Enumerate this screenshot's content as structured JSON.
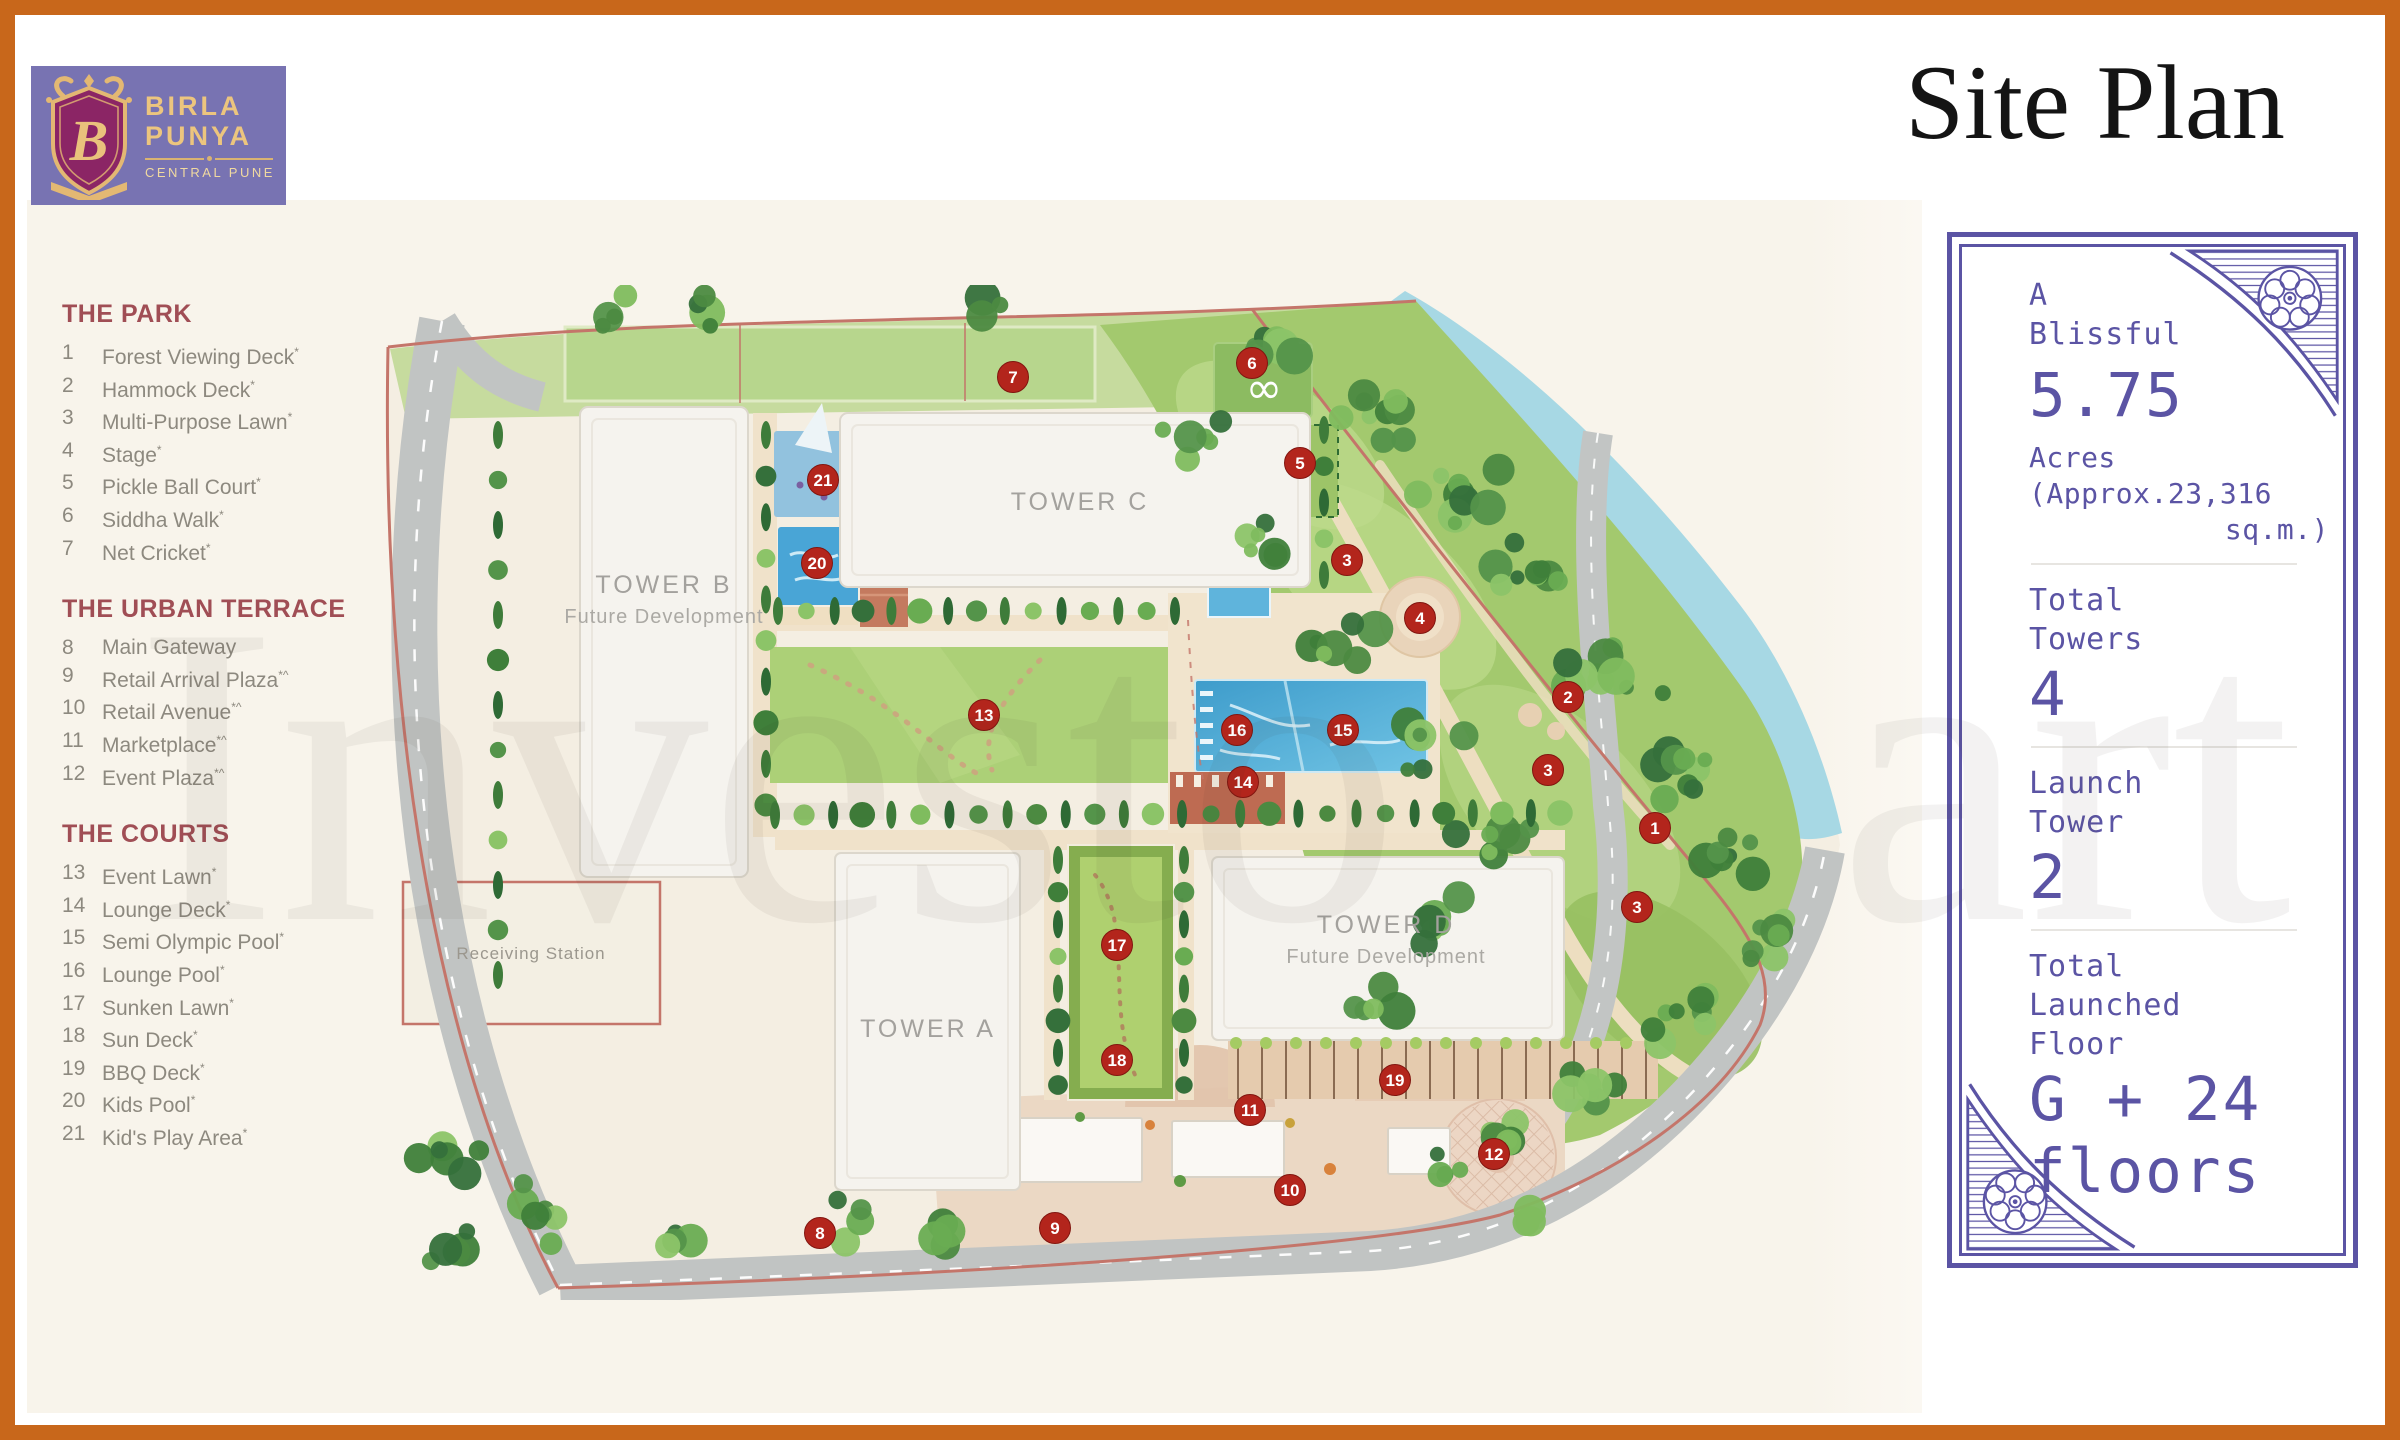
{
  "logo": {
    "name_line1": "BIRLA",
    "name_line2": "PUNYA",
    "tagline": "CENTRAL PUNE",
    "monogram": "B"
  },
  "header": {
    "title": "Site Plan"
  },
  "watermark": {
    "left_text": "Investo",
    "right_text": "art"
  },
  "legend": {
    "sections": [
      {
        "title": "THE PARK",
        "items": [
          {
            "n": "1",
            "label": "Forest Viewing Deck",
            "sup": "*"
          },
          {
            "n": "2",
            "label": "Hammock Deck",
            "sup": "*"
          },
          {
            "n": "3",
            "label": "Multi-Purpose Lawn",
            "sup": "*"
          },
          {
            "n": "4",
            "label": "Stage",
            "sup": "*"
          },
          {
            "n": "5",
            "label": "Pickle Ball Court",
            "sup": "*"
          },
          {
            "n": "6",
            "label": "Siddha Walk",
            "sup": "*"
          },
          {
            "n": "7",
            "label": "Net Cricket",
            "sup": "*"
          }
        ]
      },
      {
        "title": "THE URBAN TERRACE",
        "items": [
          {
            "n": "8",
            "label": "Main Gateway",
            "sup": ""
          },
          {
            "n": "9",
            "label": "Retail Arrival Plaza",
            "sup": "*^"
          },
          {
            "n": "10",
            "label": "Retail Avenue",
            "sup": "*^"
          },
          {
            "n": "11",
            "label": "Marketplace",
            "sup": "*^"
          },
          {
            "n": "12",
            "label": "Event Plaza",
            "sup": "*^"
          }
        ]
      },
      {
        "title": "THE COURTS",
        "items": [
          {
            "n": "13",
            "label": "Event Lawn",
            "sup": "*"
          },
          {
            "n": "14",
            "label": "Lounge Deck",
            "sup": "*"
          },
          {
            "n": "15",
            "label": "Semi Olympic Pool",
            "sup": "*"
          },
          {
            "n": "16",
            "label": "Lounge Pool",
            "sup": "*"
          },
          {
            "n": "17",
            "label": "Sunken Lawn",
            "sup": "*"
          },
          {
            "n": "18",
            "label": "Sun Deck",
            "sup": "*"
          },
          {
            "n": "19",
            "label": "BBQ Deck",
            "sup": "*"
          },
          {
            "n": "20",
            "label": "Kids Pool",
            "sup": "*"
          },
          {
            "n": "21",
            "label": "Kid's Play Area",
            "sup": "*"
          }
        ]
      }
    ]
  },
  "map": {
    "towers": [
      {
        "id": "tower-b",
        "label": "TOWER B",
        "sublabel": "Future Development",
        "x": 284,
        "y": 308
      },
      {
        "id": "tower-c",
        "label": "TOWER C",
        "sublabel": "",
        "x": 700,
        "y": 225
      },
      {
        "id": "tower-a",
        "label": "TOWER A",
        "sublabel": "",
        "x": 548,
        "y": 752
      },
      {
        "id": "tower-d",
        "label": "TOWER D",
        "sublabel": "Future Development",
        "x": 1006,
        "y": 648
      }
    ],
    "areas": [
      {
        "id": "receiving-station",
        "label": "Receiving Station",
        "x": 151,
        "y": 674
      }
    ],
    "infinity_symbol": "∞",
    "markers": [
      {
        "n": "1",
        "x": 1275,
        "y": 543
      },
      {
        "n": "2",
        "x": 1188,
        "y": 412
      },
      {
        "n": "3",
        "x": 967,
        "y": 275
      },
      {
        "n": "3",
        "x": 1168,
        "y": 485
      },
      {
        "n": "3",
        "x": 1257,
        "y": 622
      },
      {
        "n": "4",
        "x": 1040,
        "y": 333
      },
      {
        "n": "5",
        "x": 920,
        "y": 178
      },
      {
        "n": "6",
        "x": 872,
        "y": 78
      },
      {
        "n": "7",
        "x": 633,
        "y": 92
      },
      {
        "n": "8",
        "x": 440,
        "y": 948
      },
      {
        "n": "9",
        "x": 675,
        "y": 943
      },
      {
        "n": "10",
        "x": 910,
        "y": 905
      },
      {
        "n": "11",
        "x": 870,
        "y": 825
      },
      {
        "n": "12",
        "x": 1114,
        "y": 869
      },
      {
        "n": "13",
        "x": 604,
        "y": 430
      },
      {
        "n": "14",
        "x": 863,
        "y": 497
      },
      {
        "n": "15",
        "x": 963,
        "y": 445
      },
      {
        "n": "16",
        "x": 857,
        "y": 445
      },
      {
        "n": "17",
        "x": 737,
        "y": 660
      },
      {
        "n": "18",
        "x": 737,
        "y": 775
      },
      {
        "n": "19",
        "x": 1015,
        "y": 795
      },
      {
        "n": "20",
        "x": 437,
        "y": 278
      },
      {
        "n": "21",
        "x": 443,
        "y": 195
      }
    ]
  },
  "info_panel": {
    "blocks": [
      {
        "label_lines": [
          "A",
          "Blissful"
        ],
        "big_lines": [
          "5.75"
        ],
        "sub_lines": [
          "Acres",
          "(Approx.23,316"
        ],
        "sub_right": "sq.m.)"
      },
      {
        "label_lines": [
          "Total",
          "Towers"
        ],
        "big_lines": [
          "4"
        ],
        "sub_lines": [],
        "sub_right": ""
      },
      {
        "label_lines": [
          "Launch",
          "Tower"
        ],
        "big_lines": [
          "2"
        ],
        "sub_lines": [],
        "sub_right": ""
      },
      {
        "label_lines": [
          "Total",
          "Launched",
          "Floor"
        ],
        "big_lines": [
          "G + 24",
          "floors"
        ],
        "sub_lines": [],
        "sub_right": ""
      }
    ]
  },
  "colors": {
    "accent_orange": "#C8671B",
    "brand_purple": "#7873B2",
    "brand_magenta": "#8B2565",
    "gold": "#E3B873",
    "panel_indigo": "#5B54A4",
    "legend_heading": "#A04E55",
    "marker_red": "#B3251C",
    "river_blue": "#A7D8E4",
    "pool_blue": "#3E9CCB"
  }
}
